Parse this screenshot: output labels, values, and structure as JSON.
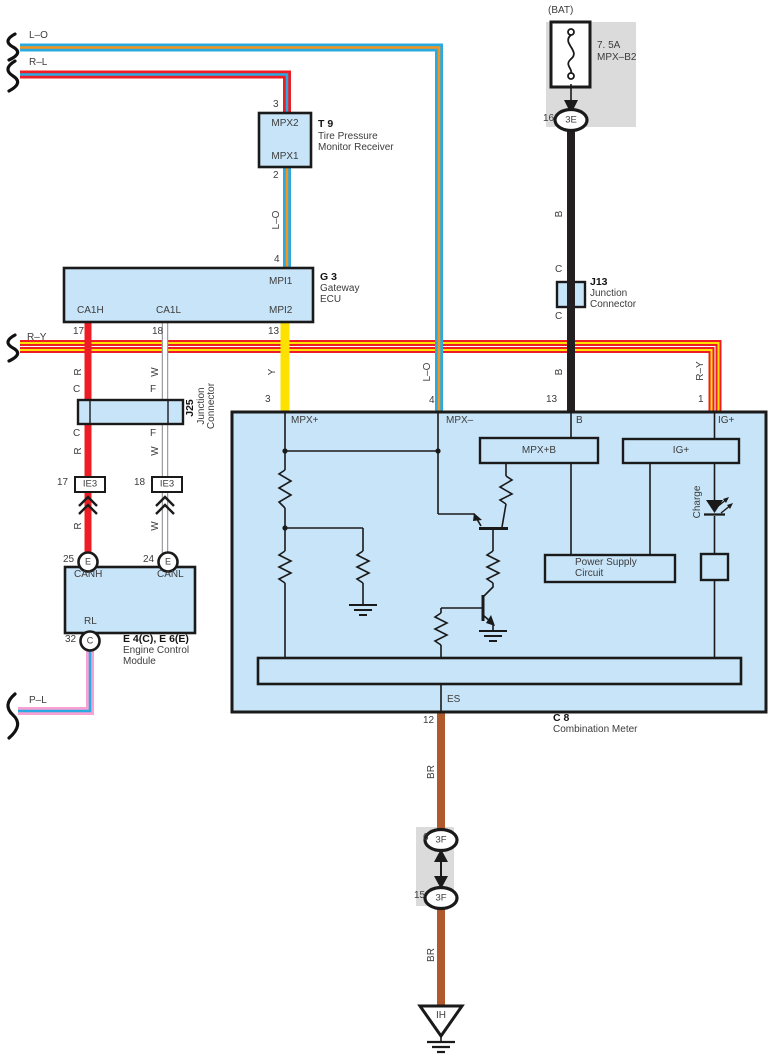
{
  "colors": {
    "wire_red": "#EE1C25",
    "wire_blue": "#29ABE2",
    "wire_orange": "#F7941E",
    "wire_yellow": "#FFE100",
    "wire_black": "#231F20",
    "wire_brown": "#B05A2B",
    "wire_pink": "#F8A0D2",
    "wire_white_edge": "#9E9FA3",
    "block_fill": "#C8E4F8",
    "connector_gray": "#DBDBDB"
  },
  "battery": {
    "bat_label": "(BAT)",
    "fuse_rating": "7. 5A",
    "fuse_name": "MPX–B2",
    "pin": "16",
    "connector": "3E"
  },
  "tpms": {
    "id": "T 9",
    "name_line1": "Tire Pressure",
    "name_line2": "Monitor Receiver",
    "pin_top": "3",
    "terminal_top": "MPX2",
    "pin_bottom": "2",
    "terminal_bottom": "MPX1"
  },
  "gateway": {
    "id": "G 3",
    "name_line1": "Gateway",
    "name_line2": "ECU",
    "pin_mpi1": "4",
    "mpi1": "MPI1",
    "pin_mpi2": "13",
    "mpi2": "MPI2",
    "pin_ca1h": "17",
    "ca1h": "CA1H",
    "pin_ca1l": "18",
    "ca1l": "CA1L"
  },
  "j25": {
    "id": "J25",
    "name_line1": "Junction",
    "name_line2": "Connector"
  },
  "j13": {
    "id": "J13",
    "name_line1": "Junction",
    "name_line2": "Connector"
  },
  "ie3_left": {
    "pin": "17",
    "label": "IE3"
  },
  "ie3_right": {
    "pin": "18",
    "label": "IE3"
  },
  "ecm": {
    "id": "E 4(C), E 6(E)",
    "name_line1": "Engine Control",
    "name_line2": "Module",
    "canh": "CANH",
    "canl": "CANL",
    "rl": "RL",
    "pin_canh": "25",
    "pin_canl": "24",
    "pin_rl": "32",
    "conn_e1": "E",
    "conn_e2": "E",
    "conn_c": "C"
  },
  "meter": {
    "id": "C 8",
    "name": "Combination Meter",
    "pin_mpx_plus": "3",
    "mpx_plus": "MPX+",
    "pin_mpx_minus": "4",
    "mpx_minus": "MPX–",
    "pin_b": "13",
    "b": "B",
    "pin_ig": "1",
    "ig": "IG+",
    "pin_es": "12",
    "es": "ES",
    "block_mpxb": "MPX+B",
    "block_ig": "IG+",
    "psu_line1": "Power Supply",
    "psu_line2": "Circuit",
    "charge": "Charge"
  },
  "floor_connector": {
    "pin_top": "6",
    "label_top": "3F",
    "pin_bottom": "15",
    "label_bottom": "3F"
  },
  "ground": {
    "id": "IH"
  },
  "wire_tags": {
    "lo_top": "L–O",
    "rl_top": "R–L",
    "lo_mid": "L–O",
    "lo_drop": "L–O",
    "ry_left": "R–Y",
    "ry_drop": "R–Y",
    "pl": "P–L",
    "y": "Y",
    "r_upper": "R",
    "r_mid": "R",
    "r_lower": "R",
    "w_upper": "W",
    "w_mid": "W",
    "w_lower": "W",
    "c_red_upper": "C",
    "c_red_lower": "C",
    "f_upper": "F",
    "f_lower": "F",
    "b_upper": "B",
    "b_lower": "B",
    "c_black_upper": "C",
    "c_black_lower": "C",
    "br_upper": "BR",
    "br_lower": "BR"
  }
}
